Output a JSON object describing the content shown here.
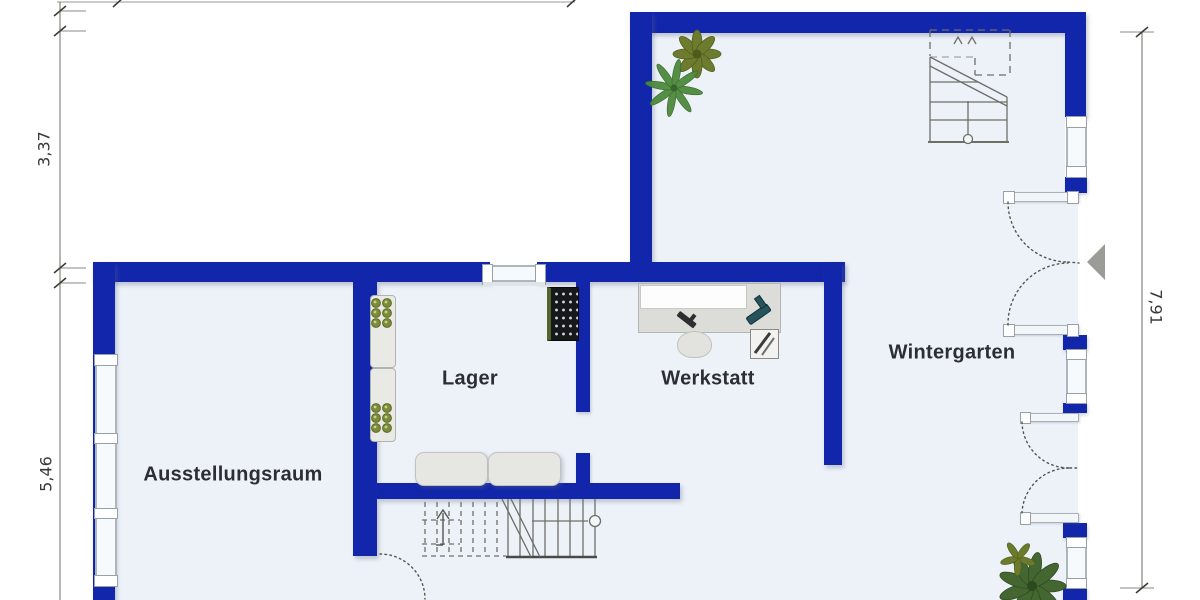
{
  "floorplan": {
    "rooms": [
      {
        "name": "Ausstellungsraum"
      },
      {
        "name": "Lager"
      },
      {
        "name": "Werkstatt"
      },
      {
        "name": "Wintergarten"
      }
    ],
    "dimensions": {
      "left_top": "3,37",
      "left_bottom": "5,46",
      "right": "7,91"
    },
    "colors": {
      "wall": "#1226ab",
      "floor": "#edf2f9",
      "entry_marker": "#9b9b97",
      "plant_green": "#4c8a3c",
      "plant_olive": "#6d7b2e"
    },
    "icons": {
      "entrance_marker": "entrance-arrow-icon",
      "door_swing": "door-swing-icon",
      "staircase": "staircase-icon",
      "plant": "plant-icon"
    }
  }
}
